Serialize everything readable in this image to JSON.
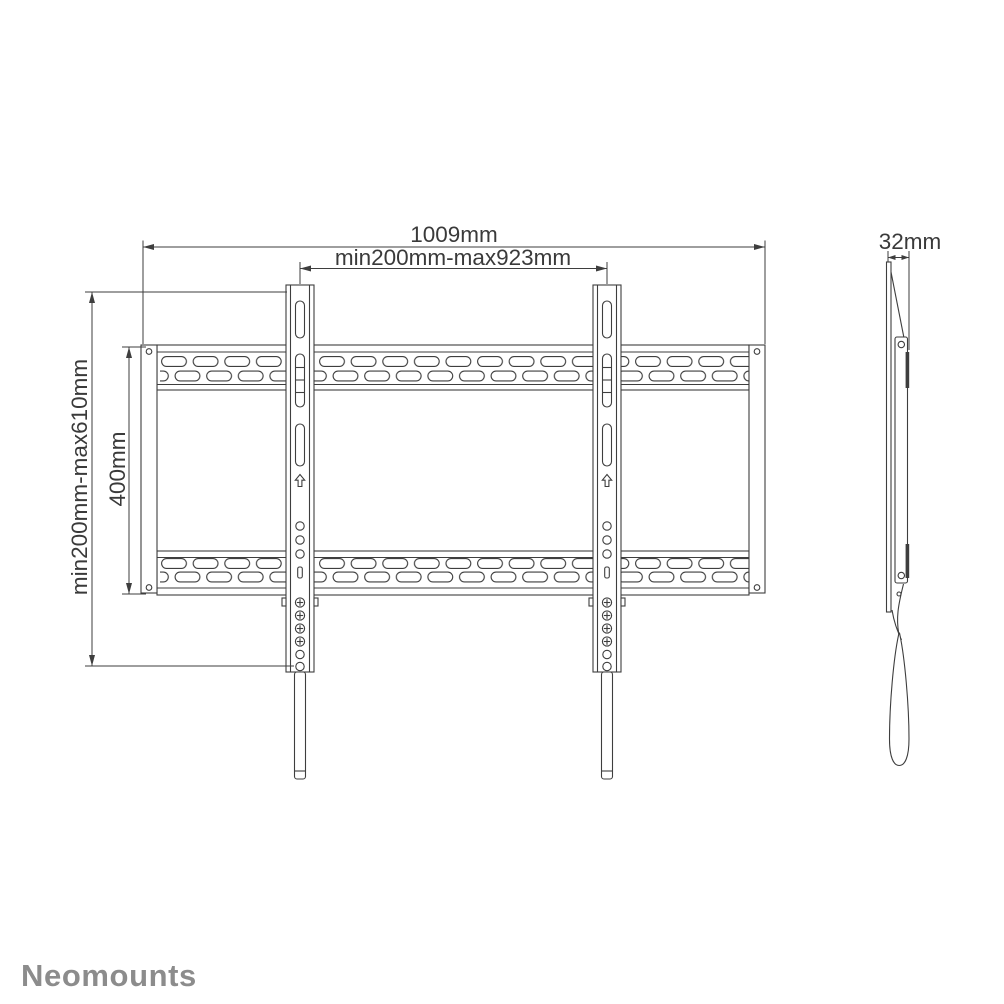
{
  "drawing": {
    "background": "#ffffff",
    "line_color": "#3e3e3e",
    "logo": {
      "text": "Neomounts",
      "color": "#8c8c8c"
    },
    "front_view": {
      "dim_total_width": "1009mm",
      "dim_bracket_span": "min200mm-max923mm",
      "dim_vesa_vertical": "min200mm-max610mm",
      "dim_rail_height": "400mm"
    },
    "side_view": {
      "dim_depth": "32mm"
    }
  }
}
